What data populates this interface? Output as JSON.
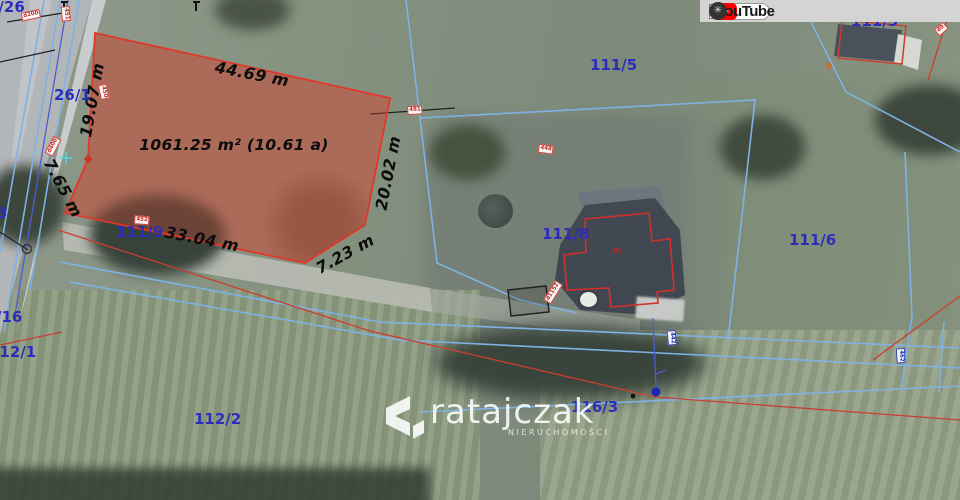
{
  "toolbar": {
    "language_select_value": "pol",
    "help_label": "?",
    "youtube_label": "YouTube"
  },
  "highlighted_parcel": {
    "area_label": "1061.25 m² (10.61 a)",
    "outline_color": "#e03828",
    "fill_color": "rgba(198,70,50,0.38)"
  },
  "measurements": [
    {
      "text": "44.69 m"
    },
    {
      "text": "19.07 m"
    },
    {
      "text": "7.65 m"
    },
    {
      "text": "33.04 m"
    },
    {
      "text": "7.23 m"
    },
    {
      "text": "20.02 m"
    }
  ],
  "parcel_labels": [
    {
      "text": "6/26"
    },
    {
      "text": "26/1"
    },
    {
      "text": "3"
    },
    {
      "text": "111/9"
    },
    {
      "text": "/16"
    },
    {
      "text": "112/1"
    },
    {
      "text": "112/2"
    },
    {
      "text": "111/5"
    },
    {
      "text": "111/8"
    },
    {
      "text": "111/6"
    },
    {
      "text": "111/3"
    },
    {
      "text": "116/3"
    }
  ],
  "point_labels": [
    {
      "text": "d200"
    },
    {
      "text": "451"
    },
    {
      "text": "450"
    },
    {
      "text": "d400"
    },
    {
      "text": "452"
    },
    {
      "text": "481"
    },
    {
      "text": "448"
    },
    {
      "text": "d1152"
    },
    {
      "text": "d9"
    },
    {
      "text": "442"
    },
    {
      "text": "462"
    }
  ],
  "building_label": {
    "text": "m"
  },
  "watermark": {
    "name": "ratajczak",
    "subtitle": "NIERUCHOMOŚCI"
  },
  "colors": {
    "parcel_label_blue": "#2d2dbb",
    "measurement_black": "#0c0c0c",
    "boundary_light_blue": "#7fb2e4",
    "boundary_red": "#c8402f",
    "toolbar_bg": "#d8d8d8",
    "youtube_red": "#ff0000",
    "help_green": "#3fae49"
  }
}
